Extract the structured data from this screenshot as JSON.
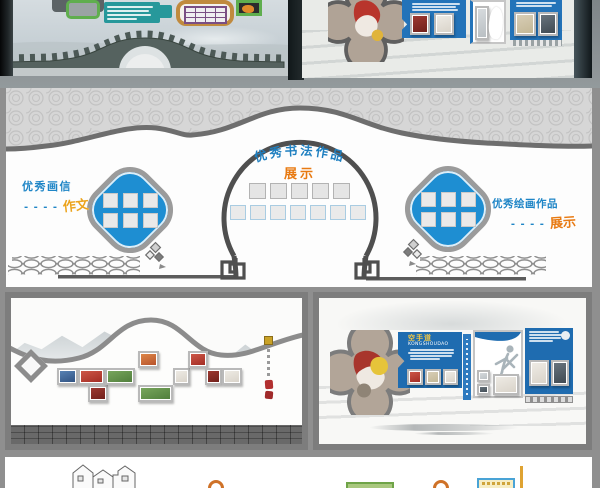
{
  "palette": {
    "page_background": "#8f8f8f",
    "wall_white": "#fdfdfd",
    "accent_blue": "#1e8ed2",
    "label_blue": "#1e85c6",
    "label_orange": "#e87a12",
    "label_gold": "#eca41d",
    "panel_blue": "#1f6cb0",
    "pattern_band_gray": "#d6d6d6",
    "outline_gray": "#6e6e6e",
    "teal": "#27989b",
    "green": "#5fae4e",
    "purple": "#7a4e84",
    "frame_orange": "#c08a3e"
  },
  "middle_wall": {
    "center_title": "优秀书法作品",
    "center_subtitle": "展示",
    "left_label": {
      "line1": "优秀画信",
      "dashes": "- - - -",
      "word": "作文"
    },
    "right_label": {
      "line1": "优秀绘画作品",
      "dashes": "- - - -",
      "word": "展示"
    }
  },
  "karate_wall": {
    "title": "空手道",
    "subtitle": "KONGSHOUDAO"
  }
}
